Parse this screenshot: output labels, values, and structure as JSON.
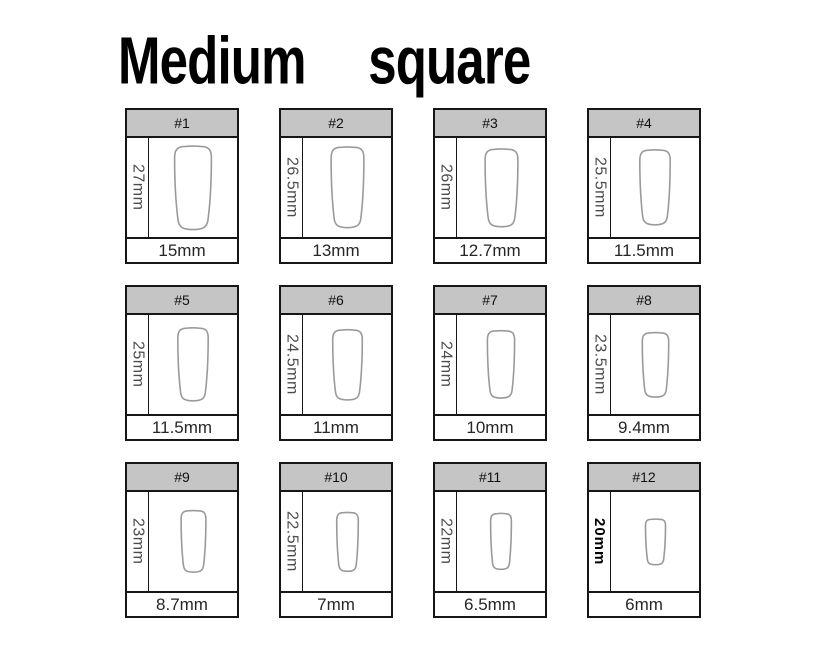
{
  "page": {
    "title": "Medium square"
  },
  "colors": {
    "header_bg": "#c5c5c5",
    "card_border": "#161616",
    "nail_outline": "#9a9a9a",
    "length_text": "#4c4c4c",
    "width_text": "#262626"
  },
  "cards": [
    {
      "number": "#1",
      "length_label": "27mm",
      "length_mm": 27,
      "width_label": "15mm",
      "width_mm": 15,
      "length_label_bold": false
    },
    {
      "number": "#2",
      "length_label": "26.5mm",
      "length_mm": 26.5,
      "width_label": "13mm",
      "width_mm": 13,
      "length_label_bold": false
    },
    {
      "number": "#3",
      "length_label": "26mm",
      "length_mm": 26,
      "width_label": "12.7mm",
      "width_mm": 12.7,
      "length_label_bold": false
    },
    {
      "number": "#4",
      "length_label": "25.5mm",
      "length_mm": 25.5,
      "width_label": "11.5mm",
      "width_mm": 11.5,
      "length_label_bold": false
    },
    {
      "number": "#5",
      "length_label": "25mm",
      "length_mm": 25,
      "width_label": "11.5mm",
      "width_mm": 11.5,
      "length_label_bold": false
    },
    {
      "number": "#6",
      "length_label": "24.5mm",
      "length_mm": 24.5,
      "width_label": "11mm",
      "width_mm": 11,
      "length_label_bold": false
    },
    {
      "number": "#7",
      "length_label": "24mm",
      "length_mm": 24,
      "width_label": "10mm",
      "width_mm": 10,
      "length_label_bold": false
    },
    {
      "number": "#8",
      "length_label": "23.5mm",
      "length_mm": 23.5,
      "width_label": "9.4mm",
      "width_mm": 9.4,
      "length_label_bold": false
    },
    {
      "number": "#9",
      "length_label": "23mm",
      "length_mm": 23,
      "width_label": "8.7mm",
      "width_mm": 8.7,
      "length_label_bold": false
    },
    {
      "number": "#10",
      "length_label": "22.5mm",
      "length_mm": 22.5,
      "width_label": "7mm",
      "width_mm": 7,
      "length_label_bold": false
    },
    {
      "number": "#11",
      "length_label": "22mm",
      "length_mm": 22,
      "width_label": "6.5mm",
      "width_mm": 6.5,
      "length_label_bold": false
    },
    {
      "number": "#12",
      "length_label": "20mm",
      "length_mm": 20,
      "width_label": "6mm",
      "width_mm": 6,
      "length_label_bold": true
    }
  ]
}
